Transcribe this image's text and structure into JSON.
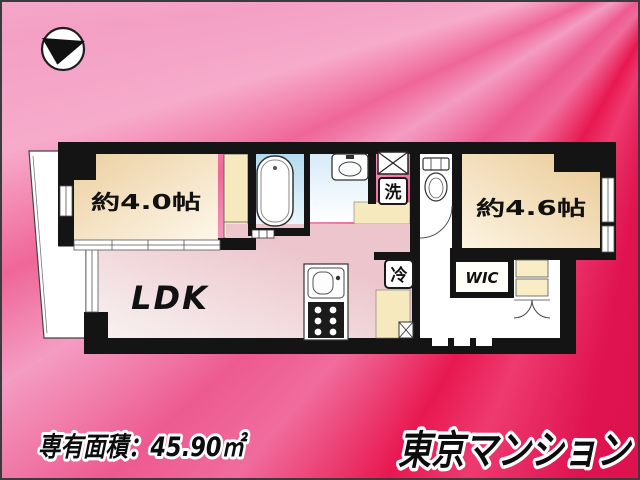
{
  "compass": {
    "icon": "north-arrow"
  },
  "floorplan": {
    "room_labels": {
      "room40": "約4.0帖",
      "room46": "約4.6帖",
      "ldk": "LDK",
      "wic": "WIC",
      "laundry": "洗",
      "fridge": "冷"
    }
  },
  "footer": {
    "area_text": "専有面積：45.90㎡",
    "brand": "東京マンション"
  },
  "colors": {
    "bg_pink_light": "#f5a6c7",
    "bg_crimson": "#dc1145",
    "room_cream": "#eccfa0",
    "closet_cream": "#f6e9be",
    "bath_blue": "#bcdff3",
    "ldk_pink": "#ecc6cc",
    "wall_black": "#141414"
  }
}
